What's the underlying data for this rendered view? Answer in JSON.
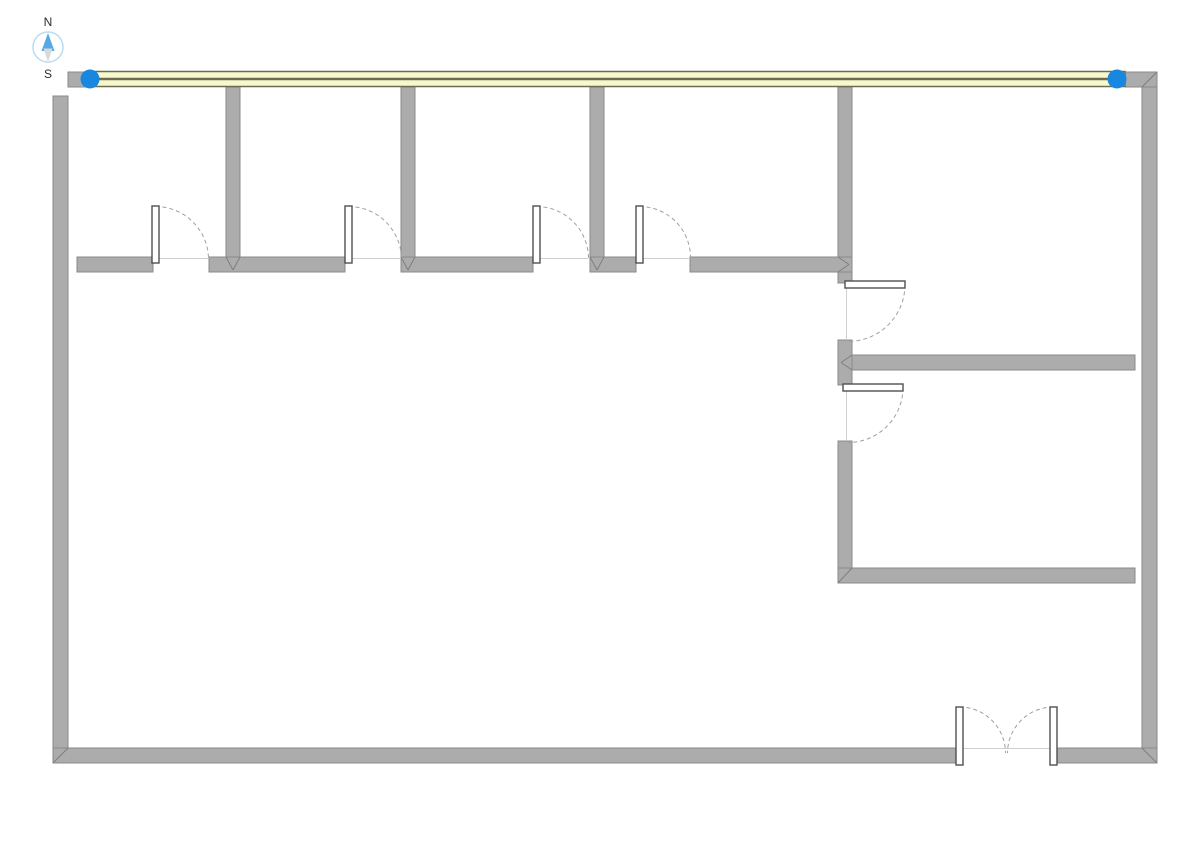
{
  "app": {
    "background": "#ffffff"
  },
  "compass": {
    "north_label": "N",
    "south_label": "S",
    "cx": 48,
    "cy": 47,
    "r": 15,
    "north_needle": "48,33 41.5,51 54.5,51",
    "south_needle": "48,62 43.5,48.5 52.5,48.5",
    "north_label_x": 48,
    "north_label_y": 26,
    "south_label_x": 48,
    "south_label_y": 78
  },
  "colors": {
    "wall_fill": "#acacac",
    "wall_stroke": "#8a8a8a",
    "miter": "#7f7f7f",
    "selected_fill": "#f8f8cd",
    "selected_stroke": "#6c6c54",
    "handle_fill": "#1787e0",
    "arc": "#a0a0a0",
    "leaf_fill": "#ffffff",
    "leaf_stroke": "#4f4f4f",
    "threshold": "#cfcfcf",
    "compass_ring": "#badcf2",
    "compass_north": "#54a8e8",
    "compass_south": "#d9d9d9",
    "compass_text": "#2d2d2d"
  },
  "selection": {
    "wall": {
      "name": "selected-wall-top-exterior",
      "x": 88,
      "y": 71.5,
      "w": 1037,
      "h": 15
    },
    "centerline": {
      "x1": 88,
      "y1": 79,
      "x2": 1125,
      "y2": 79,
      "width": 2.4
    },
    "handles": [
      {
        "name": "selection-handle-start",
        "cx": 90,
        "cy": 79,
        "r": 9.5
      },
      {
        "name": "selection-handle-end",
        "cx": 1117,
        "cy": 79,
        "r": 9.5
      }
    ]
  },
  "walls": [
    {
      "name": "wall-top-left-stub",
      "x": 68,
      "y": 72,
      "w": 20,
      "h": 15
    },
    {
      "name": "wall-top-right-stub",
      "x": 1125,
      "y": 72,
      "w": 32,
      "h": 15
    },
    {
      "name": "wall-left-exterior",
      "x": 53,
      "y": 96,
      "w": 15,
      "h": 667
    },
    {
      "name": "wall-right-exterior",
      "x": 1142,
      "y": 87,
      "w": 15,
      "h": 676
    },
    {
      "name": "wall-bottom-left",
      "x": 53,
      "y": 748,
      "w": 904,
      "h": 15
    },
    {
      "name": "wall-bottom-right",
      "x": 1056,
      "y": 748,
      "w": 101,
      "h": 15
    },
    {
      "name": "wall-partition-1",
      "x": 226,
      "y": 87,
      "w": 14,
      "h": 170
    },
    {
      "name": "wall-partition-2",
      "x": 401,
      "y": 87,
      "w": 14,
      "h": 170
    },
    {
      "name": "wall-partition-3",
      "x": 590,
      "y": 87,
      "w": 14,
      "h": 170
    },
    {
      "name": "wall-partition-4-upper",
      "x": 838,
      "y": 87,
      "w": 14,
      "h": 196
    },
    {
      "name": "wall-partition-4-mid",
      "x": 838,
      "y": 340,
      "w": 14,
      "h": 45
    },
    {
      "name": "wall-partition-4-lower",
      "x": 838,
      "y": 441,
      "w": 14,
      "h": 142
    },
    {
      "name": "wall-corridor-seg-1",
      "x": 77,
      "y": 257,
      "w": 76,
      "h": 15
    },
    {
      "name": "wall-corridor-seg-2",
      "x": 209,
      "y": 257,
      "w": 136,
      "h": 15
    },
    {
      "name": "wall-corridor-seg-3",
      "x": 401,
      "y": 257,
      "w": 132,
      "h": 15
    },
    {
      "name": "wall-corridor-seg-4",
      "x": 590,
      "y": 257,
      "w": 46,
      "h": 15
    },
    {
      "name": "wall-corridor-seg-5",
      "x": 690,
      "y": 257,
      "w": 162,
      "h": 15
    },
    {
      "name": "wall-right-wing-upper",
      "x": 852,
      "y": 355,
      "w": 283,
      "h": 15
    },
    {
      "name": "wall-right-wing-lower",
      "x": 838,
      "y": 568,
      "w": 297,
      "h": 15
    }
  ],
  "miters": [
    {
      "x1": 53,
      "y1": 763,
      "x2": 68,
      "y2": 748
    },
    {
      "x1": 1142,
      "y1": 748,
      "x2": 1157,
      "y2": 763
    },
    {
      "x1": 1142,
      "y1": 87,
      "x2": 1157,
      "y2": 72
    },
    {
      "x1": 838,
      "y1": 583,
      "x2": 852,
      "y2": 568
    },
    {
      "x1": 226,
      "y1": 257,
      "x2": 233,
      "y2": 270
    },
    {
      "x1": 240,
      "y1": 257,
      "x2": 233,
      "y2": 270
    },
    {
      "x1": 401,
      "y1": 257,
      "x2": 408,
      "y2": 270
    },
    {
      "x1": 415,
      "y1": 257,
      "x2": 408,
      "y2": 270
    },
    {
      "x1": 590,
      "y1": 257,
      "x2": 597,
      "y2": 270
    },
    {
      "x1": 604,
      "y1": 257,
      "x2": 597,
      "y2": 270
    },
    {
      "x1": 838,
      "y1": 257,
      "x2": 849,
      "y2": 264.5
    },
    {
      "x1": 838,
      "y1": 272,
      "x2": 849,
      "y2": 264.5
    },
    {
      "x1": 852,
      "y1": 355,
      "x2": 841,
      "y2": 362.5
    },
    {
      "x1": 852,
      "y1": 370,
      "x2": 841,
      "y2": 362.5
    }
  ],
  "thresholds": [
    {
      "x1": 155,
      "y1": 258.5,
      "x2": 208,
      "y2": 258.5
    },
    {
      "x1": 348,
      "y1": 258.5,
      "x2": 401,
      "y2": 258.5
    },
    {
      "x1": 536,
      "y1": 258.5,
      "x2": 588,
      "y2": 258.5
    },
    {
      "x1": 639,
      "y1": 258.5,
      "x2": 690,
      "y2": 258.5
    },
    {
      "x1": 846.5,
      "y1": 288,
      "x2": 846.5,
      "y2": 340
    },
    {
      "x1": 846.5,
      "y1": 391,
      "x2": 846.5,
      "y2": 441
    },
    {
      "x1": 963,
      "y1": 748.5,
      "x2": 1050,
      "y2": 748.5
    }
  ],
  "door_arcs": [
    {
      "name": "door-swing-arc-1",
      "d": "M 155.5 206.5 A 53 53 0 0 1 208.5 259.5"
    },
    {
      "name": "door-swing-arc-2",
      "d": "M 348.5 206.5 A 53 53 0 0 1 401.5 259.5"
    },
    {
      "name": "door-swing-arc-3",
      "d": "M 536.5 206.5 A 52 52 0 0 1 588.5 258.5"
    },
    {
      "name": "door-swing-arc-4",
      "d": "M 639.5 206.5 A 51 51 0 0 1 690.5 257.5"
    },
    {
      "name": "door-swing-arc-5",
      "d": "M 905 284.5 A 57 57 0 0 1 848 341.5"
    },
    {
      "name": "door-swing-arc-6",
      "d": "M 903 387.5 A 55 55 0 0 1 848 442.5"
    },
    {
      "name": "door-swing-arc-7-left",
      "d": "M 959.5 707 A 46 46 0 0 1 1005.5 753"
    },
    {
      "name": "door-swing-arc-7-right",
      "d": "M 1053.5 707 A 46 46 0 0 0 1007.5 753"
    }
  ],
  "door_leaves": [
    {
      "name": "door-leaf-1",
      "x": 152,
      "y": 206,
      "w": 7,
      "h": 57
    },
    {
      "name": "door-leaf-2",
      "x": 345,
      "y": 206,
      "w": 7,
      "h": 57
    },
    {
      "name": "door-leaf-3",
      "x": 533,
      "y": 206,
      "w": 7,
      "h": 57
    },
    {
      "name": "door-leaf-4",
      "x": 636,
      "y": 206,
      "w": 7,
      "h": 57
    },
    {
      "name": "door-leaf-5",
      "x": 845,
      "y": 281,
      "w": 60,
      "h": 7
    },
    {
      "name": "door-leaf-6",
      "x": 843,
      "y": 384,
      "w": 60,
      "h": 7
    },
    {
      "name": "door-leaf-7-left",
      "x": 956,
      "y": 707,
      "w": 7,
      "h": 58
    },
    {
      "name": "door-leaf-7-right",
      "x": 1050,
      "y": 707,
      "w": 7,
      "h": 58
    }
  ]
}
